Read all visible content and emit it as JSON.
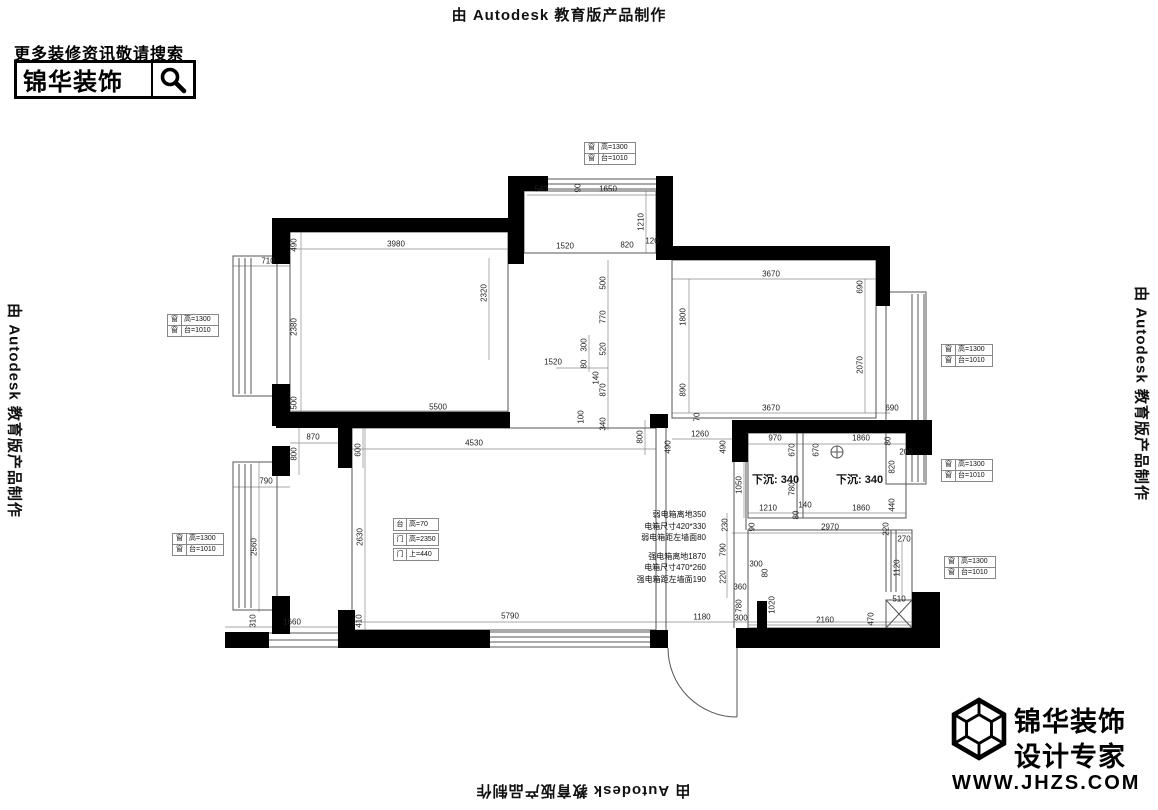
{
  "watermark": {
    "text": "由 Autodesk 教育版产品制作"
  },
  "promo": {
    "hint": "更多装修资讯敬请搜索",
    "brand": "锦华装饰"
  },
  "brand_footer": {
    "name": "锦华装饰",
    "tagline": "设计专家",
    "website": "WWW.JHZS.COM"
  },
  "plan": {
    "window_label": {
      "c1": "窗",
      "v1": "高=1300",
      "c2": "窗",
      "v2": "台=1010"
    },
    "door_label": {
      "c1": "台",
      "v1": "高=70",
      "c2": "门",
      "v2": "高=2350",
      "c3": "门",
      "v3": "上=440"
    },
    "sunken_label": "下沉: 340",
    "electrical_notes": [
      "弱电箱离地350",
      "电箱尺寸420*330",
      "弱电箱距左墙面80",
      "强电箱离地1870",
      "电箱尺寸470*260",
      "强电箱距左墙面190"
    ],
    "dimensions": [
      {
        "t": "540",
        "x": 541,
        "y": 189,
        "r": "h"
      },
      {
        "t": "90",
        "x": 578,
        "y": 188,
        "r": "v"
      },
      {
        "t": "1650",
        "x": 608,
        "y": 189,
        "r": "h"
      },
      {
        "t": "1210",
        "x": 641,
        "y": 222,
        "r": "v"
      },
      {
        "t": "1520",
        "x": 565,
        "y": 246,
        "r": "h"
      },
      {
        "t": "820",
        "x": 627,
        "y": 245,
        "r": "h"
      },
      {
        "t": "120",
        "x": 652,
        "y": 241,
        "r": "h"
      },
      {
        "t": "490",
        "x": 294,
        "y": 245,
        "r": "v"
      },
      {
        "t": "3980",
        "x": 396,
        "y": 244,
        "r": "h"
      },
      {
        "t": "710",
        "x": 268,
        "y": 261,
        "r": "h"
      },
      {
        "t": "2380",
        "x": 294,
        "y": 327,
        "r": "v"
      },
      {
        "t": "2320",
        "x": 484,
        "y": 293,
        "r": "v"
      },
      {
        "t": "500",
        "x": 294,
        "y": 403,
        "r": "v"
      },
      {
        "t": "5500",
        "x": 438,
        "y": 407,
        "r": "h"
      },
      {
        "t": "500",
        "x": 603,
        "y": 283,
        "r": "v"
      },
      {
        "t": "770",
        "x": 603,
        "y": 317,
        "r": "v"
      },
      {
        "t": "300",
        "x": 584,
        "y": 345,
        "r": "v"
      },
      {
        "t": "520",
        "x": 603,
        "y": 349,
        "r": "v"
      },
      {
        "t": "1520",
        "x": 553,
        "y": 362,
        "r": "h"
      },
      {
        "t": "80",
        "x": 584,
        "y": 364,
        "r": "v"
      },
      {
        "t": "140",
        "x": 596,
        "y": 378,
        "r": "v"
      },
      {
        "t": "870",
        "x": 603,
        "y": 390,
        "r": "v"
      },
      {
        "t": "100",
        "x": 581,
        "y": 417,
        "r": "v"
      },
      {
        "t": "340",
        "x": 603,
        "y": 424,
        "r": "v"
      },
      {
        "t": "3670",
        "x": 771,
        "y": 274,
        "r": "h"
      },
      {
        "t": "690",
        "x": 860,
        "y": 287,
        "r": "v"
      },
      {
        "t": "1800",
        "x": 683,
        "y": 317,
        "r": "v"
      },
      {
        "t": "2070",
        "x": 860,
        "y": 365,
        "r": "v"
      },
      {
        "t": "890",
        "x": 683,
        "y": 390,
        "r": "v"
      },
      {
        "t": "3670",
        "x": 771,
        "y": 408,
        "r": "h"
      },
      {
        "t": "690",
        "x": 892,
        "y": 408,
        "r": "h"
      },
      {
        "t": "70",
        "x": 697,
        "y": 417,
        "r": "v"
      },
      {
        "t": "800",
        "x": 640,
        "y": 437,
        "r": "v"
      },
      {
        "t": "1260",
        "x": 700,
        "y": 434,
        "r": "h"
      },
      {
        "t": "490",
        "x": 668,
        "y": 447,
        "r": "v"
      },
      {
        "t": "490",
        "x": 723,
        "y": 447,
        "r": "v"
      },
      {
        "t": "970",
        "x": 775,
        "y": 438,
        "r": "h"
      },
      {
        "t": "1860",
        "x": 861,
        "y": 438,
        "r": "h"
      },
      {
        "t": "80",
        "x": 888,
        "y": 441,
        "r": "v"
      },
      {
        "t": "200",
        "x": 906,
        "y": 452,
        "r": "h"
      },
      {
        "t": "670",
        "x": 792,
        "y": 450,
        "r": "v"
      },
      {
        "t": "670",
        "x": 816,
        "y": 450,
        "r": "v"
      },
      {
        "t": "820",
        "x": 892,
        "y": 467,
        "r": "v"
      },
      {
        "t": "1050",
        "x": 739,
        "y": 485,
        "r": "v"
      },
      {
        "t": "780",
        "x": 792,
        "y": 489,
        "r": "v"
      },
      {
        "t": "1210",
        "x": 768,
        "y": 508,
        "r": "h"
      },
      {
        "t": "140",
        "x": 805,
        "y": 505,
        "r": "h"
      },
      {
        "t": "80",
        "x": 796,
        "y": 515,
        "r": "v"
      },
      {
        "t": "1860",
        "x": 861,
        "y": 508,
        "r": "h"
      },
      {
        "t": "440",
        "x": 892,
        "y": 505,
        "r": "v"
      },
      {
        "t": "230",
        "x": 725,
        "y": 525,
        "r": "v"
      },
      {
        "t": "90",
        "x": 752,
        "y": 527,
        "r": "v"
      },
      {
        "t": "2970",
        "x": 830,
        "y": 527,
        "r": "h"
      },
      {
        "t": "220",
        "x": 886,
        "y": 529,
        "r": "v"
      },
      {
        "t": "270",
        "x": 904,
        "y": 539,
        "r": "h"
      },
      {
        "t": "790",
        "x": 723,
        "y": 550,
        "r": "v"
      },
      {
        "t": "300",
        "x": 756,
        "y": 564,
        "r": "h"
      },
      {
        "t": "80",
        "x": 765,
        "y": 573,
        "r": "v"
      },
      {
        "t": "1120",
        "x": 897,
        "y": 568,
        "r": "v"
      },
      {
        "t": "220",
        "x": 723,
        "y": 577,
        "r": "v"
      },
      {
        "t": "360",
        "x": 740,
        "y": 587,
        "r": "h"
      },
      {
        "t": "780",
        "x": 739,
        "y": 606,
        "r": "v"
      },
      {
        "t": "1020",
        "x": 772,
        "y": 605,
        "r": "v"
      },
      {
        "t": "300",
        "x": 741,
        "y": 618,
        "r": "h"
      },
      {
        "t": "2160",
        "x": 825,
        "y": 620,
        "r": "h"
      },
      {
        "t": "470",
        "x": 871,
        "y": 619,
        "r": "v"
      },
      {
        "t": "510",
        "x": 899,
        "y": 599,
        "r": "h"
      },
      {
        "t": "5790",
        "x": 510,
        "y": 616,
        "r": "h"
      },
      {
        "t": "1180",
        "x": 702,
        "y": 617,
        "r": "h"
      },
      {
        "t": "870",
        "x": 313,
        "y": 437,
        "r": "h"
      },
      {
        "t": "800",
        "x": 294,
        "y": 454,
        "r": "v"
      },
      {
        "t": "600",
        "x": 358,
        "y": 450,
        "r": "v"
      },
      {
        "t": "4530",
        "x": 474,
        "y": 443,
        "r": "h"
      },
      {
        "t": "2630",
        "x": 360,
        "y": 537,
        "r": "v"
      },
      {
        "t": "790",
        "x": 266,
        "y": 481,
        "r": "h"
      },
      {
        "t": "2560",
        "x": 254,
        "y": 547,
        "r": "v"
      },
      {
        "t": "310",
        "x": 253,
        "y": 621,
        "r": "v"
      },
      {
        "t": "1660",
        "x": 292,
        "y": 622,
        "r": "h"
      },
      {
        "t": "410",
        "x": 359,
        "y": 621,
        "r": "v"
      }
    ]
  },
  "colors": {
    "wall": "#000000",
    "line": "#555555",
    "dim_line": "#8a8a8a",
    "dim_text": "#222222"
  }
}
